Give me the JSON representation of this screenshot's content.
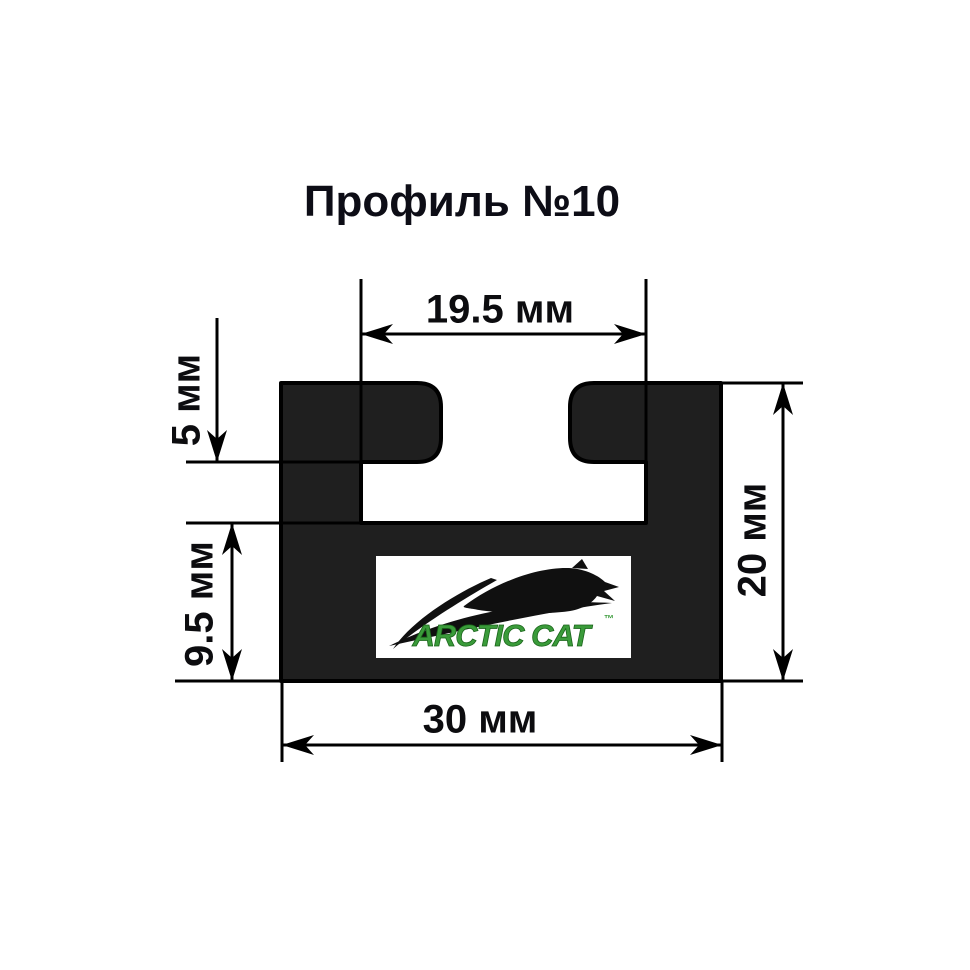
{
  "title": "Профиль №10",
  "dimensions": {
    "groove_width": "19.5 мм",
    "flange_height": "5 мм",
    "base_height": "9.5 мм",
    "total_height": "20 мм",
    "total_width": "30 мм"
  },
  "logo": {
    "brand": "ARCTIC CAT",
    "trademark": "™",
    "icon": "leaping-cat-silhouette"
  },
  "colors": {
    "profile_fill": "#1f1f1f",
    "outline": "#000000",
    "text": "#0c0c0f",
    "logo_green": "#3a9b3a",
    "background": "#ffffff"
  }
}
